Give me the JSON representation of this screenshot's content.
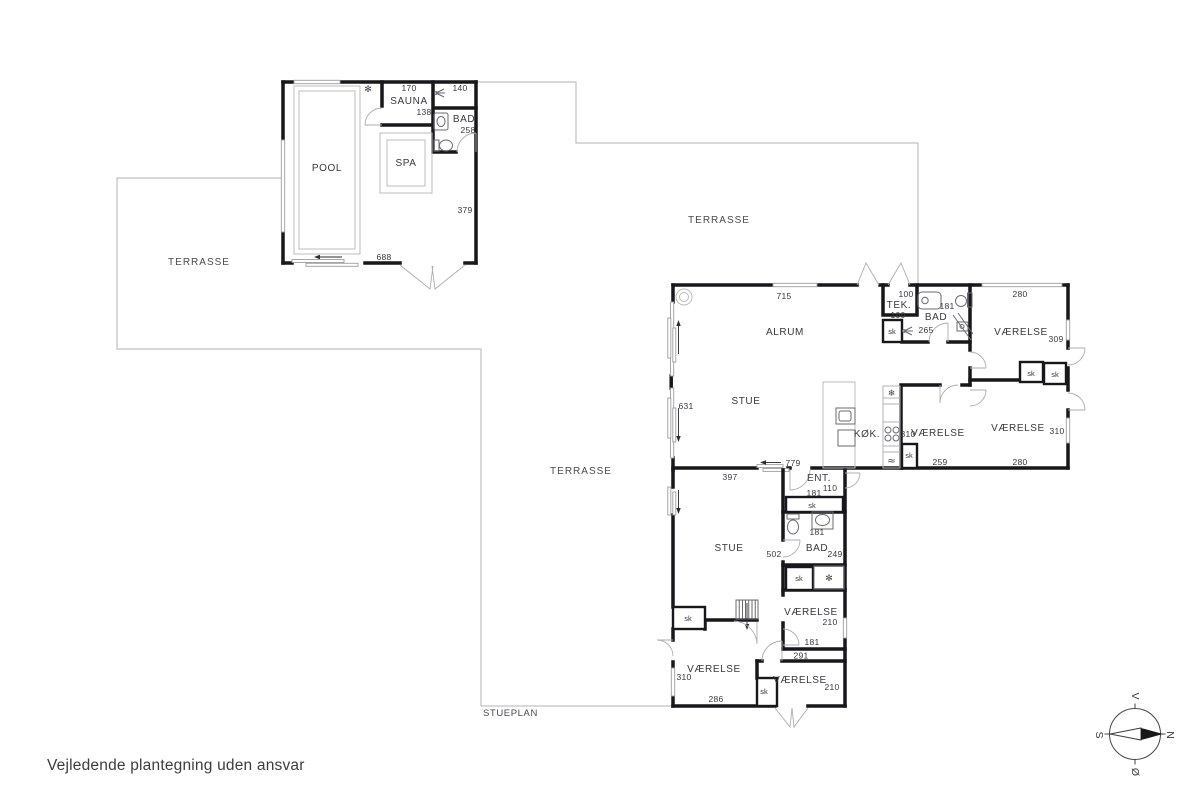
{
  "footer": {
    "disclaimer": "Vejledende plantegning uden ansvar"
  },
  "plan": {
    "name": "STUEPLAN",
    "terrace_label": "TERRASSE"
  },
  "pool_house": {
    "pool_label": "POOL",
    "spa_label": "SPA",
    "sauna_label": "SAUNA",
    "bath_label": "BAD",
    "dims": {
      "sauna_width": "170",
      "sauna_depth": "138",
      "bath_width": "140",
      "bath_depth": "258",
      "east_wall": "379",
      "south_wall": "688"
    }
  },
  "house": {
    "closet_label": "sk",
    "alrum": {
      "label": "ALRUM",
      "width": "715"
    },
    "stue": {
      "label": "STUE",
      "west": "631",
      "south": "397",
      "east": "779"
    },
    "kitchen": {
      "label": "KØK."
    },
    "tek": {
      "label": "TEK.",
      "width": "100",
      "depth": "100"
    },
    "bath_north": {
      "label": "BAD",
      "width": "181",
      "depth": "265"
    },
    "room_ne": {
      "label": "VÆRELSE",
      "width": "280",
      "depth": "309"
    },
    "room_e": {
      "label": "VÆRELSE",
      "width": "310",
      "south": "259"
    },
    "room_se": {
      "label": "VÆRELSE",
      "width": "280",
      "depth": "310"
    },
    "entry": {
      "label": "ENT.",
      "depth": "110",
      "closet_width": "181"
    },
    "stue_south": {
      "label": "STUE",
      "east": "502"
    },
    "bath_south": {
      "label": "BAD",
      "width": "181",
      "depth": "249"
    },
    "room_s1": {
      "label": "VÆRELSE",
      "depth": "210",
      "south": "181",
      "gap": "291"
    },
    "room_sw": {
      "label": "VÆRELSE",
      "west": "310",
      "south": "286"
    },
    "room_s2": {
      "label": "VÆRELSE",
      "depth": "210"
    }
  },
  "icons": {
    "freezer": "❄",
    "dishwasher": "≈",
    "shower": "✻"
  },
  "compass": {
    "north": "N",
    "south": "S",
    "east": "Ø",
    "west": "V"
  }
}
